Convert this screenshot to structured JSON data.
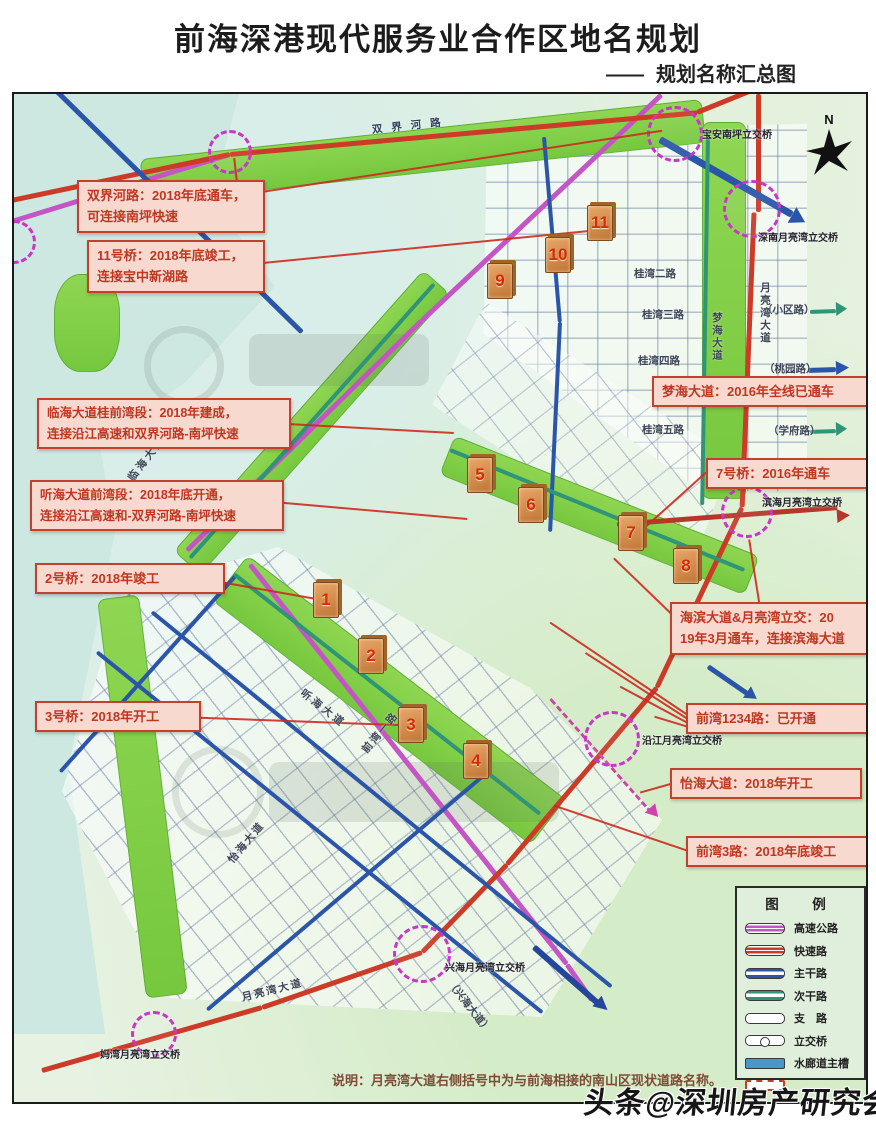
{
  "header": {
    "title": "前海深港现代服务业合作区地名规划",
    "dash": "——",
    "subtitle": "规划名称汇总图"
  },
  "annotations": [
    {
      "text": "双界河路：2018年底通车，\n可连接南坪快速"
    },
    {
      "text": "11号桥：2018年底竣工，\n连接宝中新湖路"
    },
    {
      "text": "临海大道桂前湾段：2018年建成，\n连接沿江高速和双界河路-南坪快速"
    },
    {
      "text": "听海大道前湾段：2018年底开通，\n连接沿江高速和-双界河路-南坪快速"
    },
    {
      "text": "2号桥：2018年竣工"
    },
    {
      "text": "3号桥：2018年开工"
    },
    {
      "text": "梦海大道：2016年全线已通车"
    },
    {
      "text": "7号桥：2016年通车"
    },
    {
      "text": "海滨大道&月亮湾立交：20\n19年3月通车，连接滨海大道"
    },
    {
      "text": "前湾1234路：已开通"
    },
    {
      "text": "怡海大道：2018年开工"
    },
    {
      "text": "前湾3路：2018年底竣工"
    }
  ],
  "markers": [
    "1",
    "2",
    "3",
    "4",
    "5",
    "6",
    "7",
    "8",
    "9",
    "10",
    "11"
  ],
  "interchanges": [
    "宝安南坪立交桥",
    "深南月亮湾立交桥",
    "滨海月亮湾立交桥",
    "沿江月亮湾立交桥",
    "兴海月亮湾立交桥",
    "妈湾月亮湾立交桥"
  ],
  "road_labels": [
    "双界河路",
    "桂湾二路",
    "桂湾三路",
    "桂湾四路",
    "桂湾五路",
    "（小区路）",
    "（桃园路）",
    "（学府路）",
    "梦海大道",
    "月亮湾大道",
    "临海大道",
    "听海大道",
    "前湾一路",
    "怡海大道",
    "（兴海大道）"
  ],
  "legend": {
    "title": "图　例",
    "items": [
      {
        "label": "高速公路",
        "color": "#c455c4"
      },
      {
        "label": "快速路",
        "color": "#cc3a28"
      },
      {
        "label": "主干路",
        "color": "#2b55a8"
      },
      {
        "label": "次干路",
        "color": "#2f9478"
      },
      {
        "label": "支　路",
        "color": "#ffffff"
      },
      {
        "label": "立交桥",
        "color": "#ffffff"
      },
      {
        "label": "水廊道主槽",
        "color": "#4a96c8"
      },
      {
        "label": "",
        "color": "#cc3a28"
      }
    ]
  },
  "compass_label": "N",
  "note": "说明：月亮湾大道右侧括号中为与前海相接的南山区现状道路名称。",
  "watermark": "头条@深圳房产研究会",
  "palette": {
    "expressway": "#c455c4",
    "fast_road": "#cc3a28",
    "main_road": "#2b55a8",
    "secondary_road": "#2f9478",
    "corridor_green": "#7fce4b",
    "water": "#cde8e1",
    "annotation_bg": "#f7d9cf",
    "annotation_border": "#c2402c",
    "marker_block": "#cf8a50",
    "interchange_circle": "#c837c8"
  }
}
